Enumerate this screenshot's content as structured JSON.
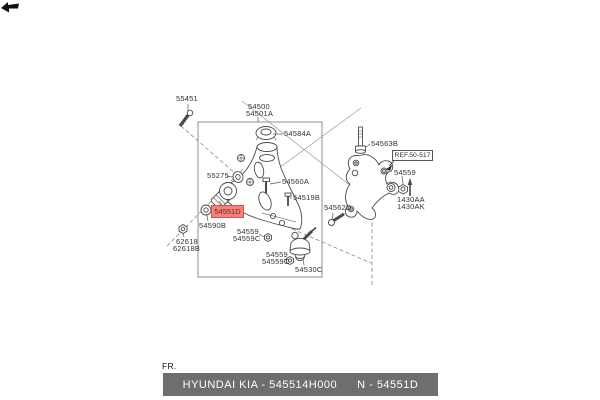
{
  "labels": {
    "l55451": "55451",
    "l54500": "54500",
    "l54501A": "54501A",
    "l54584A": "54584A",
    "l55275": "55275",
    "l54560A": "54560A",
    "l54519B": "54519B",
    "l54551D": "54551D",
    "l54590B": "54590B",
    "l54559_1": "54559",
    "l54559C_1": "54559C",
    "l62618": "62618",
    "l62618B": "62618B",
    "l54559_2": "54559",
    "l54559C_2": "54559C",
    "l54530C": "54530C",
    "l54562D": "54562D",
    "l54563B": "54563B",
    "lref": "REF.50-517",
    "l54559_3": "54559",
    "l1430AA": "1430AA",
    "l1430AK": "1430AK"
  },
  "direction_indicator": {
    "label": "FR.",
    "icon": "bold-left-arrow"
  },
  "highlight": {
    "part": "54551D",
    "bg": "#f2837b",
    "border": "#d8534b",
    "text_color": "#7c1d15"
  },
  "footer": {
    "left": "HYUNDAI  KIA - 545514H000",
    "right": "N - 54551D",
    "bg": "#6e6e6e",
    "text_color": "#ffffff"
  },
  "colors": {
    "background": "#ffffff",
    "line": "#4a4a4a",
    "box_border": "#8f8f8f",
    "construction_line": "#888888"
  }
}
